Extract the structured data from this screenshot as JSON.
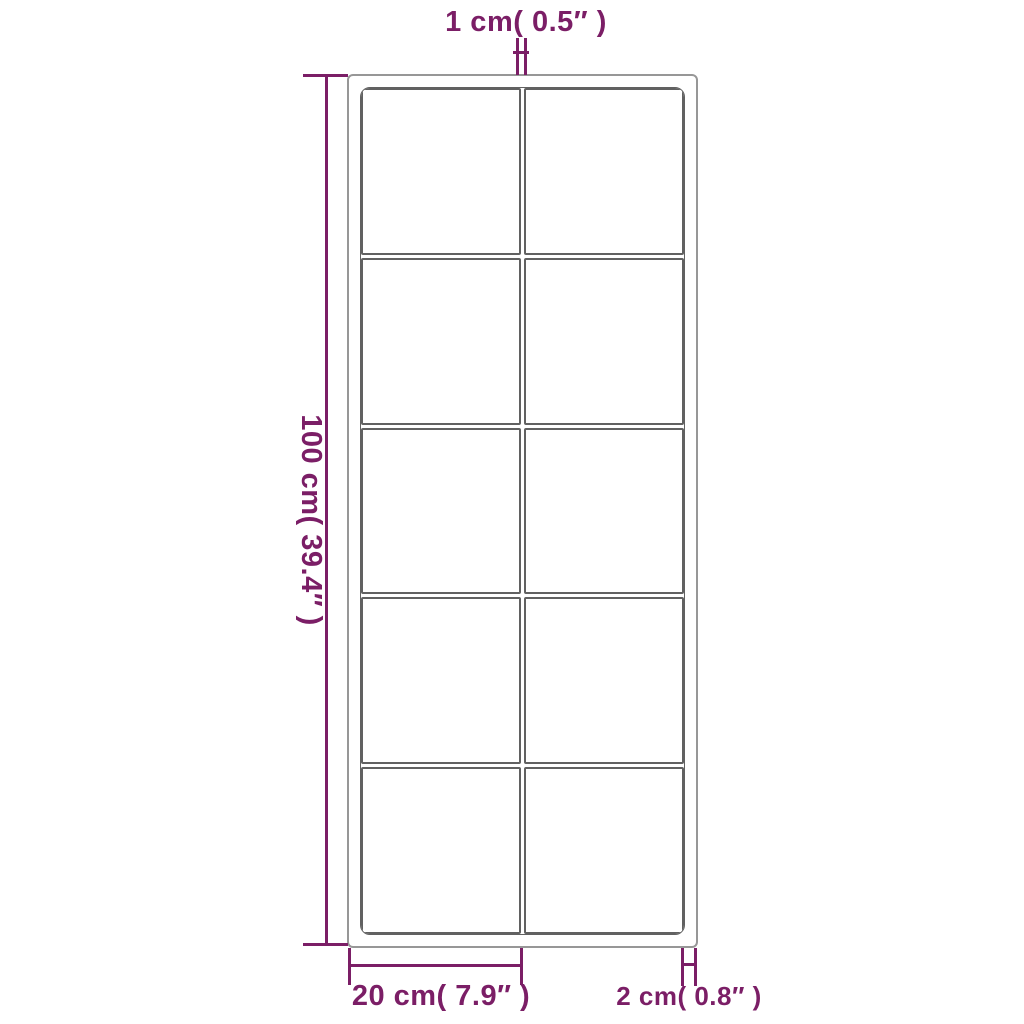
{
  "diagram": {
    "type": "product-dimension-diagram",
    "product": "grid-pane frame (2 columns x 5 rows)",
    "labels": {
      "top": "1 cm( 0.5″ )",
      "left": "100 cm( 39.4″ )",
      "bottom": "20 cm( 7.9″ )",
      "bottom_right": "2 cm( 0.8″ )"
    },
    "grid": {
      "columns": 2,
      "rows": 5,
      "panes": 10
    }
  },
  "colors": {
    "dimension": "#7b1e66",
    "frame_dark": "#616161",
    "frame_light": "#979797",
    "bg": "#ffffff"
  }
}
